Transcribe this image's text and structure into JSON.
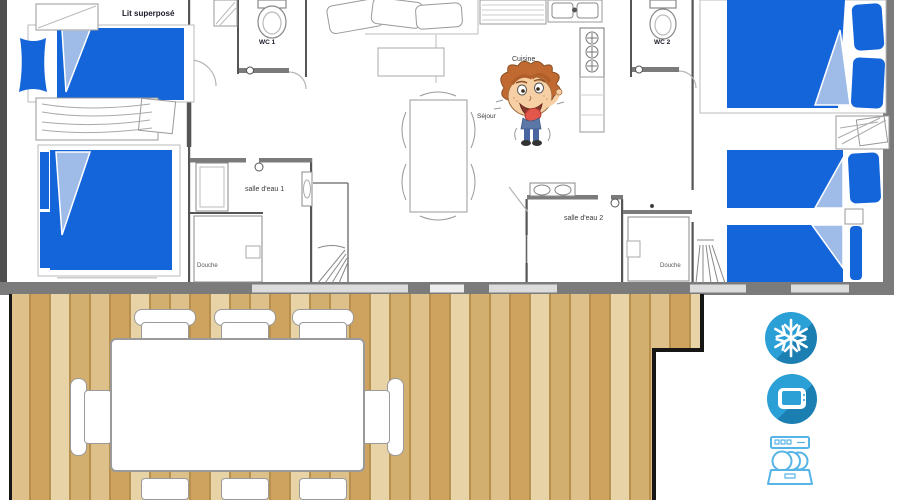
{
  "floorplan": {
    "labels": {
      "bunk_bed": "Lit superposé",
      "wc1": "WC 1",
      "wc2": "WC 2",
      "kitchen": "Cuisine",
      "living_room": "Séjour",
      "bathroom1": "salle d'eau 1",
      "bathroom2": "salle d'eau 2",
      "shower1": "Douche",
      "shower2": "Douche"
    }
  },
  "amenities": {
    "items": [
      {
        "name": "air-conditioning",
        "icon": "snowflake-icon",
        "glyph": "❄"
      },
      {
        "name": "television",
        "icon": "tv-icon"
      },
      {
        "name": "dishwasher",
        "icon": "dishwasher-icon"
      }
    ]
  },
  "colors": {
    "bed_blue": "#1365D9",
    "bed_fold_blue": "#9FBCE9",
    "wall_gray": "#7B7B7B",
    "wall_dark": "#4F4F4F",
    "window_gray": "#DCDCDC",
    "icon_blue": "#2AA0D6",
    "icon_shadow_blue": "#1C7FB2",
    "appliance_outline_blue": "#57B4E6",
    "deck_border_black": "#161616",
    "wood_plank_light": "#E7D3A6",
    "wood_plank_mid": "#DEC08A",
    "wood_plank_tan": "#CDA35F",
    "wood_plank_deep": "#D2AF6F",
    "wood_gap": "#B8904E"
  }
}
